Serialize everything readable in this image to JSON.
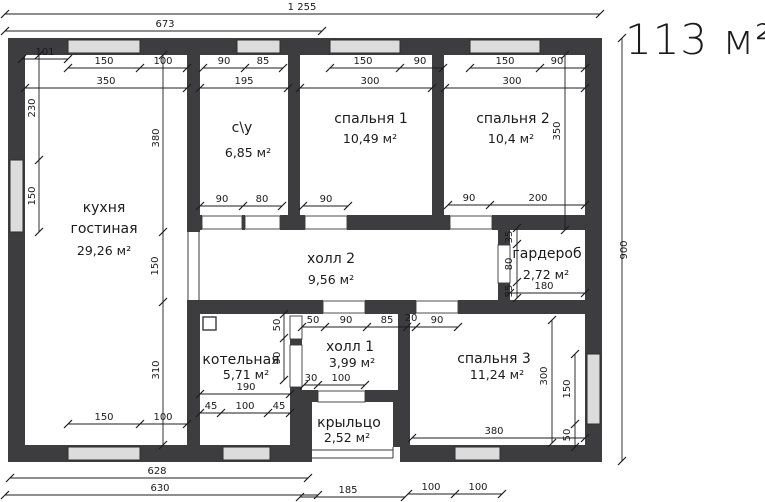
{
  "watermark": "113 м²",
  "rooms": [
    {
      "name": "кухня",
      "name2": "гостиная",
      "area": "29,26 м²"
    },
    {
      "name": "с\\у",
      "area": "6,85 м²"
    },
    {
      "name": "спальня 1",
      "area": "10,49 м²"
    },
    {
      "name": "спальня 2",
      "area": "10,4 м²"
    },
    {
      "name": "холл 2",
      "area": "9,56 м²"
    },
    {
      "name": "гардероб",
      "area": "2,72 м²"
    },
    {
      "name": "котельная",
      "area": "5,71 м²"
    },
    {
      "name": "холл 1",
      "area": "3,99 м²"
    },
    {
      "name": "спальня 3",
      "area": "11,24 м²"
    },
    {
      "name": "крыльцо",
      "area": "2,52 м²"
    }
  ],
  "dims": [
    "1 255",
    "673",
    "101",
    "150",
    "100",
    "350",
    "90",
    "85",
    "195",
    "150",
    "90",
    "300",
    "150",
    "90",
    "300",
    "230",
    "150",
    "380",
    "150",
    "310",
    "150",
    "100",
    "90",
    "80",
    "90",
    "90",
    "200",
    "35",
    "80",
    "35",
    "180",
    "50",
    "90",
    "190",
    "45",
    "100",
    "45",
    "50",
    "90",
    "85",
    "20",
    "90",
    "30",
    "100",
    "300",
    "150",
    "50",
    "380",
    "100",
    "100",
    "628",
    "630",
    "185",
    "900",
    "350"
  ],
  "colors": {
    "wall": "#3d3d3f",
    "window": "#dcdcdc",
    "line": "#1c1c1c",
    "watermark": "#d4d4d4"
  }
}
